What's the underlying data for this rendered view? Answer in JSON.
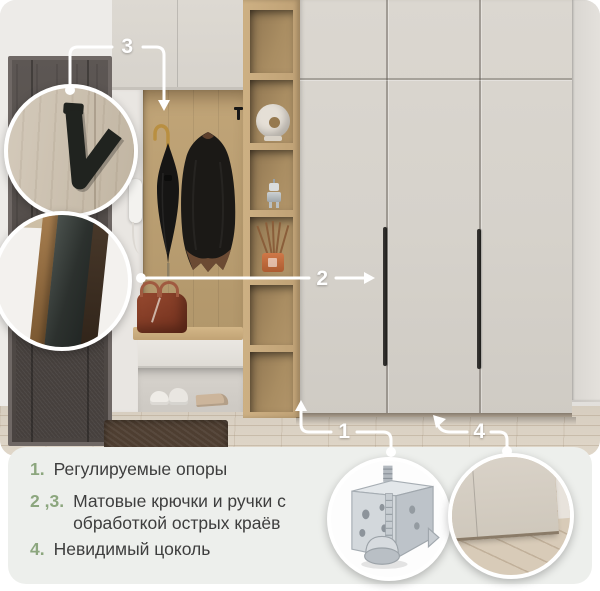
{
  "palette": {
    "accent_green": "#8CA67E",
    "annotation_color": "#FFFFFF",
    "panel_bg": "#EDEFEC",
    "cabinet_greige": "#D7D3CC",
    "wood_oak": "#C3A77B",
    "door_dark": "#554E4B"
  },
  "callouts": {
    "one": "1",
    "two": "2",
    "three": "3",
    "four": "4"
  },
  "legend": {
    "items": [
      {
        "num": "1.",
        "text": "Регулируемые опоры"
      },
      {
        "num": "2 ,3.",
        "text": "Матовые крючки и ручки с обработкой острых краёв"
      },
      {
        "num": "4.",
        "text": "Невидимый цоколь"
      }
    ]
  },
  "icons": {
    "hook_inset": "matte-v-hook-closeup",
    "handle_inset": "matte-recessed-handle-closeup",
    "foot_inset": "adjustable-metal-foot-closeup",
    "plinth_inset": "invisible-plinth-closeup"
  }
}
